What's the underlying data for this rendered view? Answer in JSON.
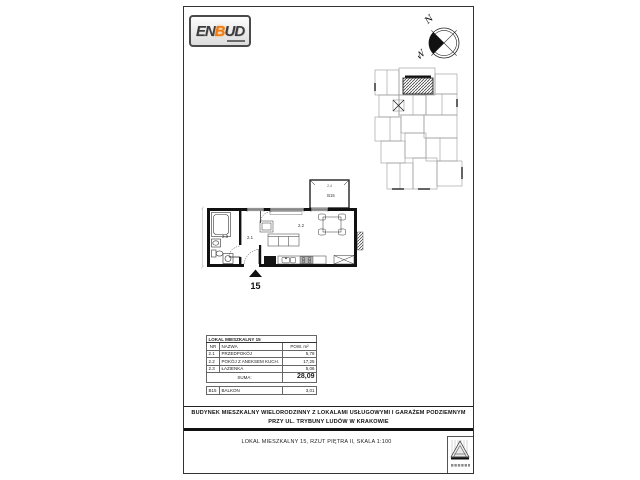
{
  "brand": {
    "en": "EN",
    "b": "B",
    "ud": "UD",
    "full": "ENBUD"
  },
  "compass": {
    "north": "N",
    "west": "W"
  },
  "plan": {
    "unit_number": "15",
    "labels": {
      "hall": "2.1",
      "room": "2.2",
      "bath": "2.3"
    },
    "balcony": {
      "id": "B15",
      "dim": "2,4"
    }
  },
  "table": {
    "title": "LOKAL MIESZKALNY 15",
    "columns": [
      "NR",
      "NAZWA",
      "POW. m²"
    ],
    "rows": [
      {
        "nr": "2.1",
        "nazwa": "PRZEDPOKÓJ",
        "pow": "5,78"
      },
      {
        "nr": "2.2",
        "nazwa": "POKÓJ Z ANEKSEM KUCH.",
        "pow": "17,25"
      },
      {
        "nr": "2.3",
        "nazwa": "ŁAZIENKA",
        "pow": "5,06"
      }
    ],
    "suma_label": "SUMA:",
    "suma_value": "28,09",
    "balcony_row": {
      "nr": "B15",
      "nazwa": "BALKON",
      "pow": "3,01"
    }
  },
  "title_block": {
    "line1": "BUDYNEK MIESZKALNY WIELORODZINNY Z LOKALAMI USŁUGOWYMI I GARAŻEM PODZIEMNYM",
    "line2": "PRZY UL. TRYBUNY LUDÓW W KRAKOWIE",
    "subtitle": "LOKAL MIESZKALNY 15, RZUT PIĘTRA II, SKALA 1:100"
  }
}
